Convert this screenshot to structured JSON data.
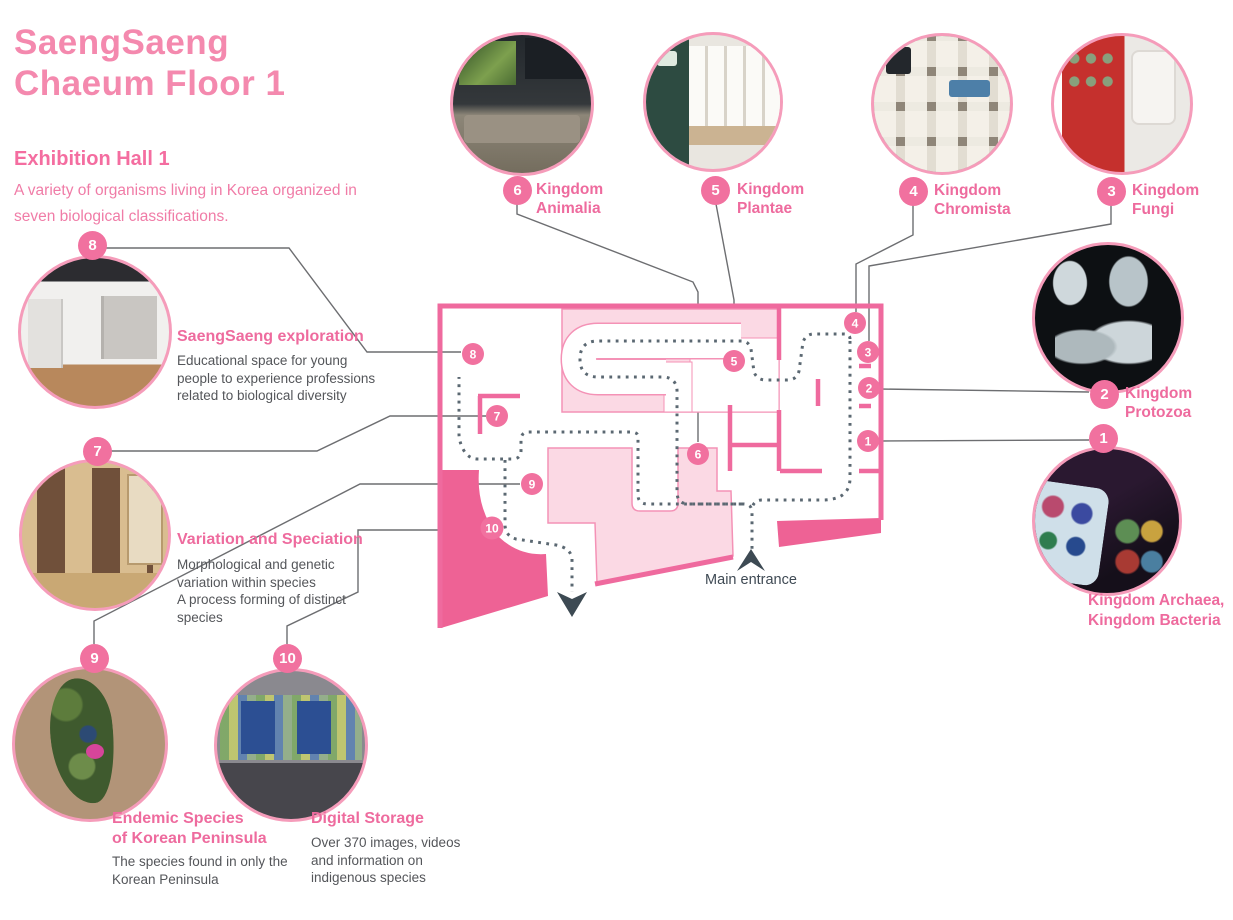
{
  "header": {
    "title_line1": "SaengSaeng",
    "title_line2": "Chaeum Floor 1",
    "hall": "Exhibition Hall 1",
    "desc_line1": "A variety of organisms living in Korea organized in",
    "desc_line2": "seven biological classifications."
  },
  "map": {
    "entrance_label": "Main entrance",
    "marker_numbers": [
      "1",
      "2",
      "3",
      "4",
      "5",
      "6",
      "7",
      "8",
      "9",
      "10"
    ]
  },
  "colors": {
    "brand_pink": "#f489ae",
    "label_pink": "#ee6b9e",
    "wall_pink": "#ef6a9e",
    "pale_pink_fill": "#fbd9e4",
    "dark_pink_fill": "#ee6295",
    "badge_pink": "#f1719f",
    "path_gray": "#5b6872",
    "text_gray": "#54565a",
    "connector_gray": "#6d6e71"
  },
  "stations": [
    {
      "num": "1",
      "name": [
        "Kingdom Archaea,",
        "Kingdom Bacteria"
      ],
      "desc": []
    },
    {
      "num": "2",
      "name": [
        "Kingdom",
        "Protozoa"
      ],
      "desc": []
    },
    {
      "num": "3",
      "name": [
        "Kingdom",
        "Fungi"
      ],
      "desc": []
    },
    {
      "num": "4",
      "name": [
        "Kingdom",
        "Chromista"
      ],
      "desc": []
    },
    {
      "num": "5",
      "name": [
        "Kingdom",
        "Plantae"
      ],
      "desc": []
    },
    {
      "num": "6",
      "name": [
        "Kingdom",
        "Animalia"
      ],
      "desc": []
    },
    {
      "num": "7",
      "name": [
        "Variation and Speciation"
      ],
      "desc": [
        "Morphological and genetic",
        "variation within species",
        "A process forming of distinct",
        "species"
      ]
    },
    {
      "num": "8",
      "name": [
        "SaengSaeng exploration"
      ],
      "desc": [
        "Educational space for young",
        "people to experience professions",
        "related to biological diversity"
      ]
    },
    {
      "num": "9",
      "name": [
        "Endemic Species",
        "of Korean Peninsula"
      ],
      "desc": [
        "The species found in only the",
        "Korean Peninsula"
      ]
    },
    {
      "num": "10",
      "name": [
        "Digital Storage"
      ],
      "desc": [
        "Over 370 images, videos",
        "and information on",
        "indigenous species"
      ]
    }
  ]
}
